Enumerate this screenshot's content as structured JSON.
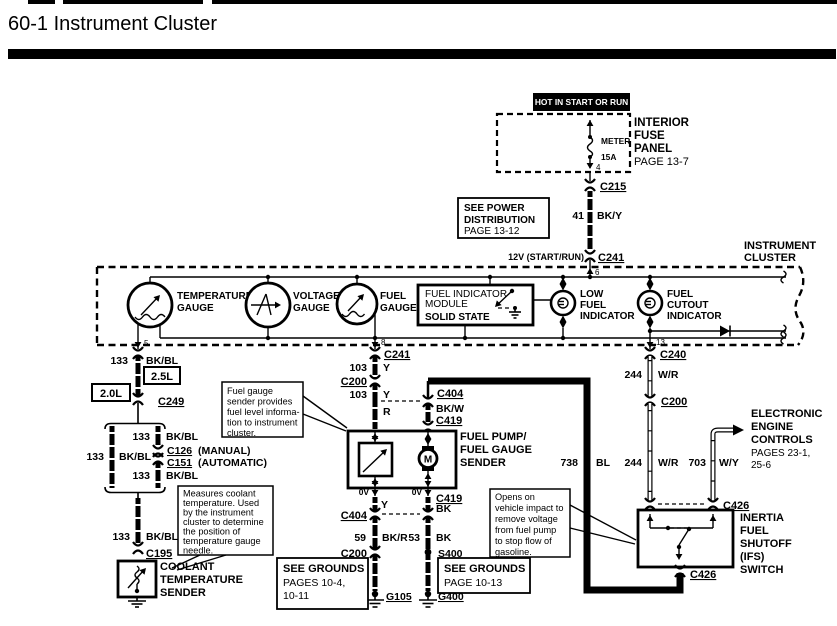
{
  "title": "60-1 Instrument Cluster",
  "feed": {
    "hot": "HOT IN START OR RUN",
    "panel": [
      "INTERIOR",
      "FUSE",
      "PANEL",
      "PAGE 13-7"
    ],
    "fuse_name": "METER",
    "fuse_rating": "15A",
    "see_power": [
      "SEE POWER",
      "DISTRIBUTION",
      "PAGE 13-12"
    ],
    "v12": "12V (START/RUN)"
  },
  "cluster": {
    "label": [
      "INSTRUMENT",
      "CLUSTER"
    ],
    "temp": [
      "TEMPERATURE",
      "GAUGE"
    ],
    "volt": [
      "VOLTAGE",
      "GAUGE"
    ],
    "fuel": [
      "FUEL",
      "GAUGE"
    ],
    "fim": [
      "FUEL INDICATOR",
      "MODULE",
      "SOLID STATE"
    ],
    "low_fuel": [
      "LOW",
      "FUEL",
      "INDICATOR"
    ],
    "cutout": [
      "FUEL",
      "CUTOUT",
      "INDICATOR"
    ]
  },
  "pins": {
    "p4": "4",
    "p5": "5",
    "p6": "6",
    "p8": "8",
    "p13": "13"
  },
  "conn": {
    "c215": "C215",
    "c241": "C241",
    "c240": "C240",
    "c249": "C249",
    "c200": "C200",
    "c195": "C195",
    "c126": "C126",
    "c151": "C151",
    "c404": "C404",
    "c419": "C419",
    "c426": "C426",
    "s400": "S400",
    "g105": "G105",
    "g400": "G400"
  },
  "wires": {
    "w41": {
      "num": "41",
      "color": "BK/Y"
    },
    "w133": {
      "num": "133",
      "color": "BK/BL"
    },
    "w103": {
      "num": "103",
      "color": "Y"
    },
    "r": "R",
    "y": "Y",
    "bkw": "BK/W",
    "bk": "BK",
    "w59": {
      "num": "59",
      "color": "BK/R"
    },
    "w53": {
      "num": "53",
      "color": "BK"
    },
    "w244": {
      "num": "244",
      "color": "W/R"
    },
    "w738": {
      "num": "738",
      "color": "BL"
    },
    "w703": {
      "num": "703",
      "color": "W/Y"
    },
    "ov": "0V"
  },
  "engines": {
    "e25": "2.5L",
    "e20": "2.0L",
    "manual": "(MANUAL)",
    "automatic": "(AUTOMATIC)"
  },
  "components": {
    "pump": [
      "FUEL PUMP/",
      "FUEL GAUGE",
      "SENDER"
    ],
    "motor": "M",
    "coolant_sender": [
      "COOLANT",
      "TEMPERATURE",
      "SENDER"
    ],
    "ifs": [
      "INERTIA",
      "FUEL",
      "SHUTOFF",
      "(IFS)",
      "SWITCH"
    ],
    "eec": [
      "ELECTRONIC",
      "ENGINE",
      "CONTROLS",
      "PAGES 23-1,",
      "25-6"
    ]
  },
  "notes": {
    "coolant": [
      "Measures coolant",
      "temperature. Used",
      "by the instrument",
      "cluster to determine",
      "the position of",
      "temperature gauge",
      "needle."
    ],
    "fuel_sender": [
      "Fuel gauge",
      "sender provides",
      "fuel level informa-",
      "tion to instrument",
      "cluster."
    ],
    "ifs": [
      "Opens on",
      "vehicle impact to",
      "remove voltage",
      "from fuel pump",
      "to stop flow of",
      "gasoline."
    ]
  },
  "grounds": {
    "left": [
      "SEE GROUNDS",
      "PAGES 10-4,",
      "10-11"
    ],
    "right": [
      "SEE GROUNDS",
      "PAGE 10-13"
    ]
  }
}
